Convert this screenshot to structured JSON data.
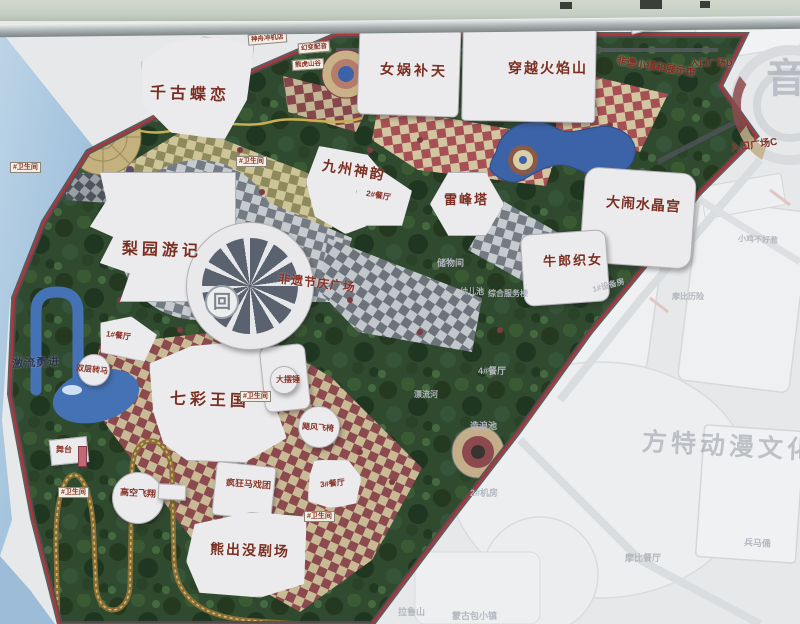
{
  "scene": "photographed theme-park guide map on an outdoor sign board",
  "labels": {
    "attractions": [
      "千古蝶恋",
      "女娲补天",
      "穿越火焰山",
      "九州神韵",
      "雷峰塔",
      "大闹水晶宫",
      "牛郎织女",
      "梨园游记",
      "非遗节庆广场",
      "七彩王国",
      "熊出没剧场",
      "激流勇进",
      "非遗小镇和展示馆",
      "入口广场E",
      "入口广场D",
      "入口广场C",
      "总仓"
    ],
    "rides": [
      "疯狂马戏团",
      "高空飞翔",
      "双层转马",
      "大摆锤",
      "飓风飞椅",
      "舞台",
      "2#餐厅",
      "1#餐厅",
      "3#餐厅",
      "幻变配音",
      "神舟冲机店",
      "熊虎山谷"
    ],
    "faded": [
      "储物间",
      "幼儿池",
      "综合服务楼",
      "4#餐厅",
      "漂流河",
      "造浪池",
      "2#机房",
      "兵马俑",
      "摩比餐厅",
      "小鸡不好惹",
      "1#设备房",
      "蒙古包小镇",
      "拉鲁山",
      "摩比历险"
    ]
  },
  "tags": {
    "toilet": "#卫生间"
  },
  "watermarks": {
    "main": "方特动漫文化科技",
    "side": "音"
  },
  "medallion_glyph": "回",
  "colors": {
    "park_border_red": "#b23434",
    "road_gray": "#4b4f55",
    "tree_green": "#2f4a2e",
    "building_white": "#ebebed",
    "label_red": "#7b2f22",
    "water_blue": "#4572b5",
    "coaster_gold": "#8a6f38",
    "sky_blue": "#a6c4de",
    "faded_bg": "#e7e8ea"
  }
}
